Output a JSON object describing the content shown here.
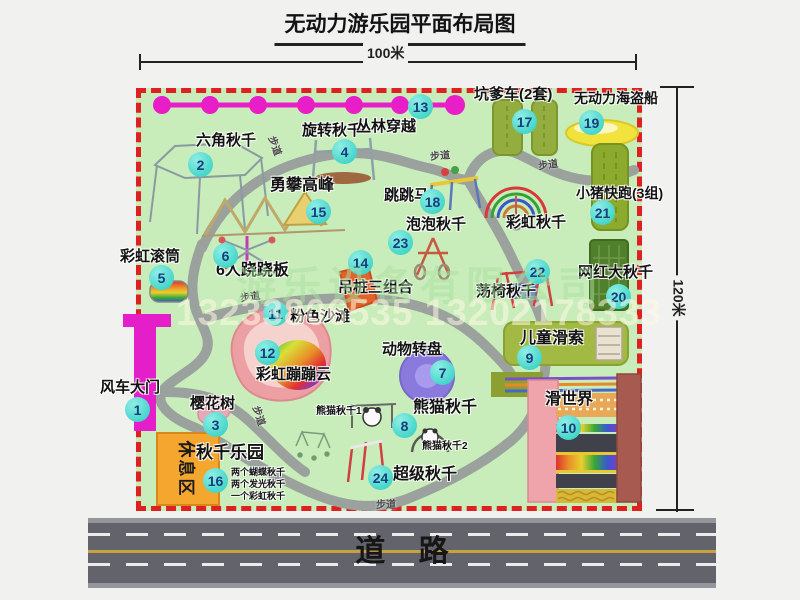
{
  "title": "无动力游乐园平面布局图",
  "dimensions": {
    "width_label": "100米",
    "height_label": "120米"
  },
  "road": {
    "label": "道    路"
  },
  "watermark": {
    "company": "游乐设备有限公司",
    "phone": "13233806535 13202178333"
  },
  "rest_area": {
    "label": "休息区"
  },
  "path_label": "步道",
  "rainbow_swing_label": "彩虹秋千",
  "attractions": [
    {
      "num": "1",
      "label": "风车大门"
    },
    {
      "num": "2",
      "label": "六角秋千"
    },
    {
      "num": "3",
      "label": "樱花树"
    },
    {
      "num": "4",
      "label": "旋转秋千"
    },
    {
      "num": "5",
      "label": "彩虹滚筒"
    },
    {
      "num": "6",
      "label": "6人跷跷板"
    },
    {
      "num": "7",
      "label": "动物转盘"
    },
    {
      "num": "8",
      "label": "熊猫秋千",
      "sub1": "熊猫秋千1",
      "sub2": "熊猫秋千2"
    },
    {
      "num": "9",
      "label": "儿童滑索"
    },
    {
      "num": "10",
      "label": "滑世界"
    },
    {
      "num": "11",
      "label": "粉色沙滩"
    },
    {
      "num": "12",
      "label": "彩虹蹦蹦云"
    },
    {
      "num": "13",
      "label": "丛林穿越"
    },
    {
      "num": "14",
      "label": "吊桩三组合"
    },
    {
      "num": "15",
      "label": "勇攀高峰"
    },
    {
      "num": "16",
      "label": "秋千乐园",
      "notes": [
        "两个蝴蝶秋千",
        "两个发光秋千",
        "一个彩虹秋千"
      ]
    },
    {
      "num": "17",
      "label": "坑爹车(2套)"
    },
    {
      "num": "18",
      "label": "跳跳马"
    },
    {
      "num": "19",
      "label": "无动力海盗船"
    },
    {
      "num": "20",
      "label": "网红大秋千"
    },
    {
      "num": "21",
      "label": "小猪快跑(3组)"
    },
    {
      "num": "22",
      "label": "荡椅秋千"
    },
    {
      "num": "23",
      "label": "泡泡秋千"
    },
    {
      "num": "24",
      "label": "超级秋千"
    }
  ],
  "colors": {
    "map_green": "#c8ecba",
    "border_red": "#df2020",
    "badge_teal": "#2accc0",
    "zipline_magenta": "#e81ec8",
    "gate_magenta": "#e41ec8",
    "rest_orange": "#f5a62e",
    "road_gray": "#63636b",
    "path_gray": "#9ba19d"
  }
}
